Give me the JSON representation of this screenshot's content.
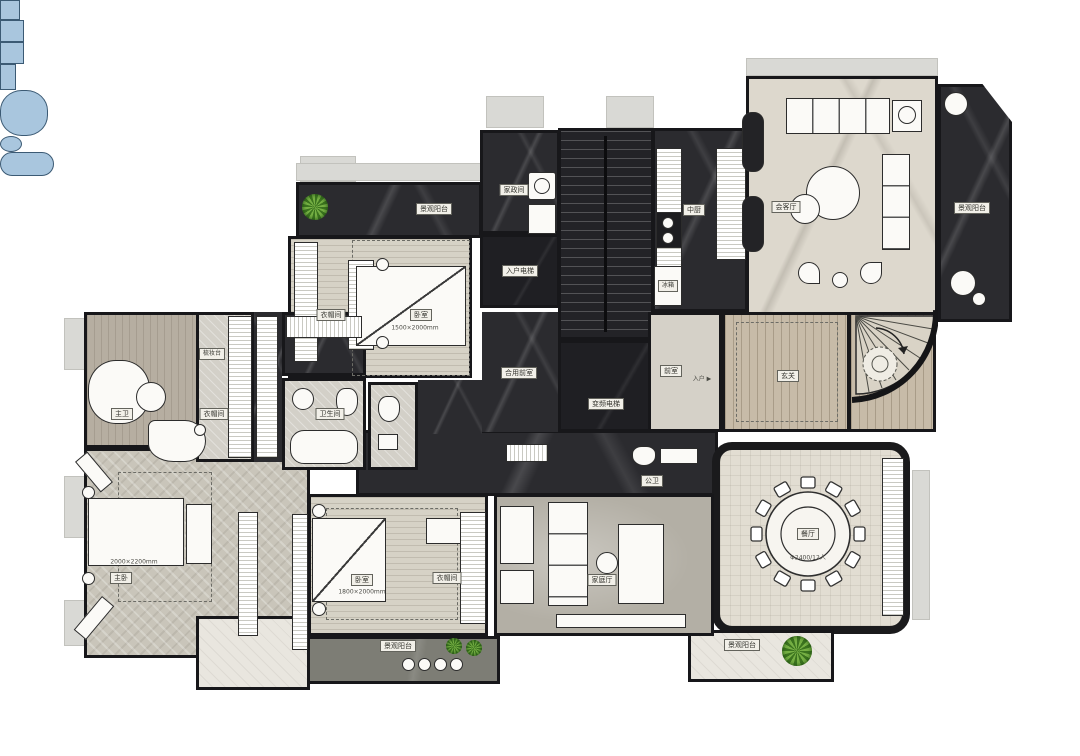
{
  "plan": {
    "balconies": {
      "top_left": "景观阳台",
      "right": "景观阳台",
      "bottom_right": "景观阳台",
      "bottom_center": "景观阳台"
    },
    "rooms": {
      "housekeeping": "家政间",
      "home_elevator": "入户电梯",
      "kitchen": "中厨",
      "fridge": "冰箱",
      "living_room": "会客厅",
      "anteroom": "前室",
      "entry": "入户",
      "foyer": "玄关",
      "shared_anteroom": "合用前室",
      "elevator": "变频电梯",
      "powder_room": "公卫",
      "dining_room": "餐厅",
      "dining_table_spec": "Φ2400/12人",
      "family_room": "家庭厅",
      "bedroom_top": "卧室",
      "bedroom_top_bed_size": "1500×2000mm",
      "bedroom_top_closet": "衣帽间",
      "bedroom_bottom": "卧室",
      "bedroom_bottom_bed_size": "1800×2000mm",
      "bedroom_bottom_closet": "衣帽间",
      "master_bedroom": "主卧",
      "master_bed_size": "2000×2200mm",
      "master_bath": "主卫",
      "master_closet": "衣帽间",
      "dressing_table": "梳妆台",
      "bathroom": "卫生间"
    }
  }
}
